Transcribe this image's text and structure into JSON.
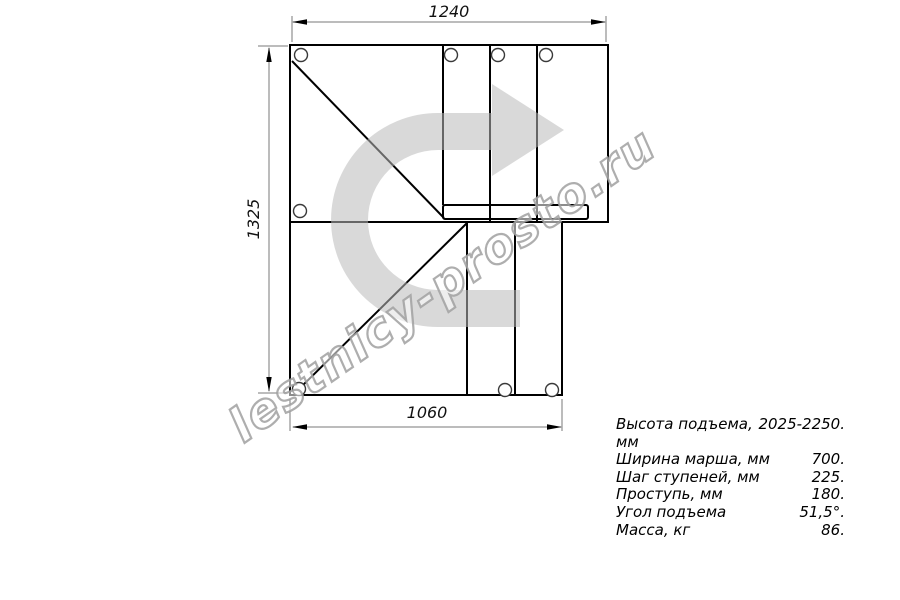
{
  "watermark": {
    "text": "lestnicy-prosto.ru"
  },
  "dimensions": {
    "top_width_mm": "1240",
    "left_height_mm": "1325",
    "bottom_width_mm": "1060"
  },
  "direction_arrow": {
    "meaning": "turn-right-ascent-direction"
  },
  "specs": {
    "rows": [
      {
        "label": "Высота подъема, мм",
        "value": "2025-2250."
      },
      {
        "label": "Ширина марша, мм",
        "value": "700."
      },
      {
        "label": "Шаг ступеней, мм",
        "value": "225."
      },
      {
        "label": "Проступь, мм",
        "value": "180."
      },
      {
        "label": "Угол подъема",
        "value": "51,5°."
      },
      {
        "label": "Масса, кг",
        "value": "86."
      }
    ]
  },
  "colors": {
    "outline": "#000000",
    "dimension_line": "#7a7a7a",
    "arrow_fill": "#b9b9b9",
    "watermark_stroke": "#a0a0a0"
  }
}
